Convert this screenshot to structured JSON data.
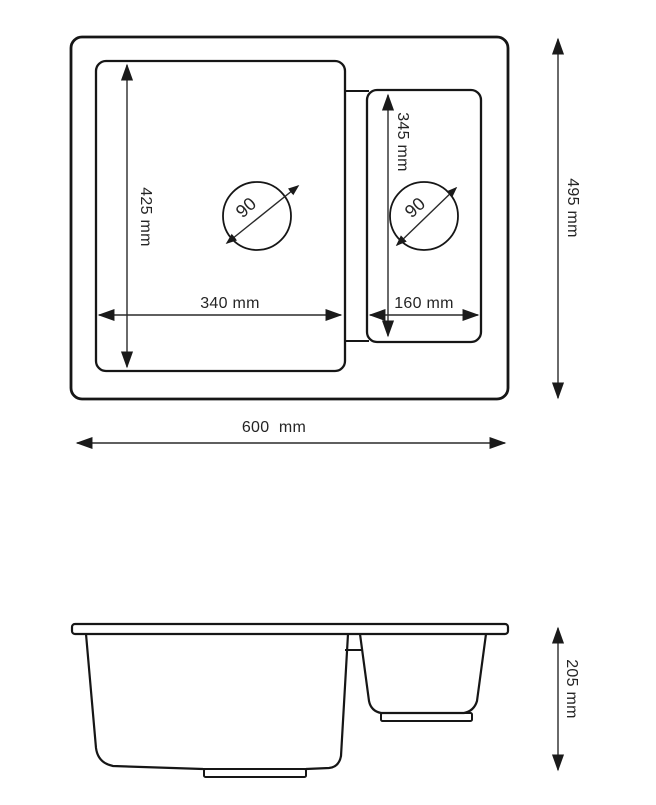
{
  "drawing": {
    "title": "sink-dimension-drawing",
    "colors": {
      "line": "#161616",
      "dimension_line": "#2a2a2a",
      "text": "#252525",
      "background": "#ffffff"
    },
    "top_view": {
      "overall_width_label": "600  mm",
      "overall_height_label": "495 mm",
      "main_bowl": {
        "width_label": "340 mm",
        "height_label": "425 mm",
        "drain_diameter_label": "90"
      },
      "small_bowl": {
        "width_label": "160 mm",
        "height_label": "345 mm",
        "drain_diameter_label": "90"
      }
    },
    "side_view": {
      "depth_label": "205 mm"
    }
  }
}
